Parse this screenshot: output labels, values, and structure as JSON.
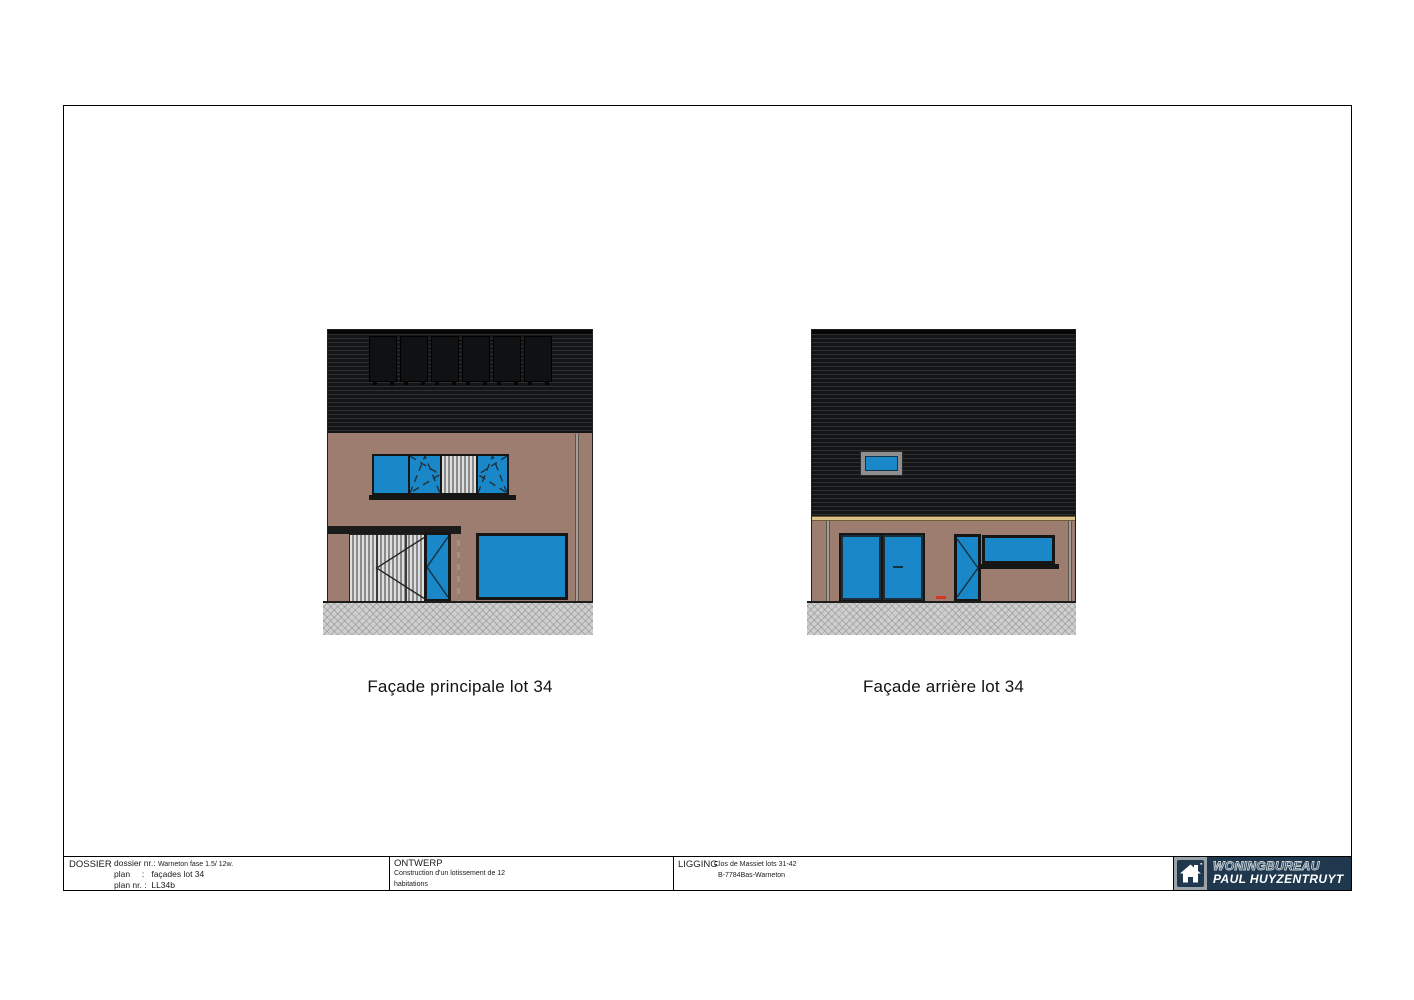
{
  "captions": {
    "left": "Façade principale lot 34",
    "right": "Façade arrière lot 34"
  },
  "title_block": {
    "dossier": {
      "section_label": "DOSSIER",
      "rows": [
        {
          "label": "dossier nr.: ",
          "value": "Warneton fase 1.5/ 12w."
        },
        {
          "label": "plan     :   ",
          "value": "façades lot 34"
        },
        {
          "label": "plan nr. :  ",
          "value": "LL34b"
        }
      ]
    },
    "ontwerp": {
      "section_label": "ONTWERP",
      "line1": "Construction d'un lotissement de 12",
      "line2": "habitations"
    },
    "ligging": {
      "section_label": "LIGGING",
      "line1": "Clos de Massiet lots 31-42",
      "line2": "B-7784Bas-Warneton"
    },
    "logo": {
      "line1": "WONINGBUREAU",
      "line2": "PAUL HUYZENTRUYT"
    }
  },
  "colors": {
    "cladding_dark": "#1b1d1f",
    "wall_brown": "#9c7d6f",
    "window_blue": "#1987c8",
    "frame_dark": "#161616",
    "accent_band_tan": "#d9c087",
    "sidewalk_gray": "#cfcfcf",
    "logo_navy": "#20384e",
    "red_marker": "#d63425"
  }
}
